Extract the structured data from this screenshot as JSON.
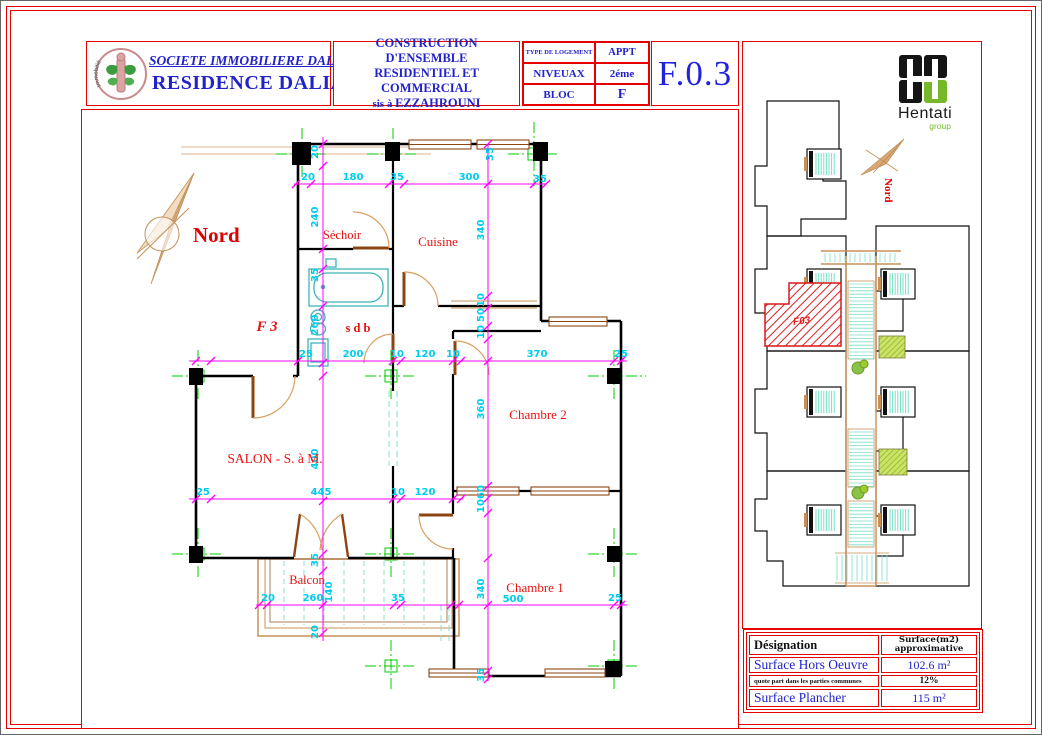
{
  "header": {
    "logo_arc_text": "Immobilière Dalia",
    "company": "SOCIETE  IMMOBILIERE DALIA",
    "residence": "RESIDENCE DALIA",
    "project_line1": "CONSTRUCTION D'ENSEMBLE",
    "project_line2": "RESIDENTIEL ET COMMERCIAL",
    "location_prefix": "sis à ",
    "location": "EZZAHROUNI",
    "type_table": {
      "r1c1": "TYPE DE LOGEMENT",
      "r1c2": "APPT",
      "r2c1": "NIVEUAX",
      "r2c2": "2éme",
      "r3c1": "BLOC",
      "r3c2": "F"
    },
    "code": "F.0.3"
  },
  "plan": {
    "north": "Nord",
    "flat_label": "F 3",
    "room_labels": [
      {
        "t": "Séchoir",
        "x": 341,
        "y": 238,
        "s": 12.5
      },
      {
        "t": "Cuisine",
        "x": 437,
        "y": 245,
        "s": 13
      },
      {
        "t": "s d b",
        "x": 357,
        "y": 331,
        "s": 12.5,
        "b": 1
      },
      {
        "t": "SALON - S. à M.",
        "x": 274,
        "y": 462,
        "s": 13.5
      },
      {
        "t": "Chambre 2",
        "x": 537,
        "y": 418,
        "s": 13
      },
      {
        "t": "Chambre 1",
        "x": 534,
        "y": 591,
        "s": 13
      },
      {
        "t": "Balcon",
        "x": 306,
        "y": 583,
        "s": 12.5
      }
    ],
    "dim_labels_h": [
      {
        "t": "20",
        "x": 307,
        "y": 179
      },
      {
        "t": "180",
        "x": 352,
        "y": 179
      },
      {
        "t": "35",
        "x": 396,
        "y": 179
      },
      {
        "t": "300",
        "x": 468,
        "y": 179
      },
      {
        "t": "35",
        "x": 539,
        "y": 181
      },
      {
        "t": "25",
        "x": 305,
        "y": 356
      },
      {
        "t": "200",
        "x": 352,
        "y": 356
      },
      {
        "t": "10",
        "x": 396,
        "y": 356
      },
      {
        "t": "120",
        "x": 424,
        "y": 356
      },
      {
        "t": "10",
        "x": 452,
        "y": 356
      },
      {
        "t": "370",
        "x": 536,
        "y": 356
      },
      {
        "t": "25",
        "x": 620,
        "y": 356
      },
      {
        "t": "25",
        "x": 202,
        "y": 494
      },
      {
        "t": "445",
        "x": 320,
        "y": 494
      },
      {
        "t": "10",
        "x": 397,
        "y": 494
      },
      {
        "t": "120",
        "x": 424,
        "y": 494
      },
      {
        "t": "20",
        "x": 267,
        "y": 600
      },
      {
        "t": "260",
        "x": 312,
        "y": 600
      },
      {
        "t": "35",
        "x": 397,
        "y": 600
      },
      {
        "t": "500",
        "x": 512,
        "y": 601
      },
      {
        "t": "25",
        "x": 614,
        "y": 600
      }
    ],
    "dim_labels_v": [
      {
        "t": "20",
        "x": 317,
        "y": 151
      },
      {
        "t": "240",
        "x": 317,
        "y": 216
      },
      {
        "t": "35",
        "x": 317,
        "y": 274
      },
      {
        "t": "260",
        "x": 317,
        "y": 324
      },
      {
        "t": "400",
        "x": 317,
        "y": 458
      },
      {
        "t": "35",
        "x": 317,
        "y": 559
      },
      {
        "t": "20",
        "x": 317,
        "y": 631
      },
      {
        "t": "140",
        "x": 331,
        "y": 591
      },
      {
        "t": "340",
        "x": 483,
        "y": 229
      },
      {
        "t": "10",
        "x": 483,
        "y": 299
      },
      {
        "t": "50",
        "x": 483,
        "y": 314
      },
      {
        "t": "10",
        "x": 483,
        "y": 331
      },
      {
        "t": "360",
        "x": 483,
        "y": 408
      },
      {
        "t": "60",
        "x": 483,
        "y": 491
      },
      {
        "t": "10",
        "x": 483,
        "y": 505
      },
      {
        "t": "340",
        "x": 483,
        "y": 588
      },
      {
        "t": "35",
        "x": 483,
        "y": 674
      },
      {
        "t": "35",
        "x": 492,
        "y": 153
      }
    ]
  },
  "site": {
    "north": "Nord",
    "brand": "Hentati",
    "brand_sub": "group",
    "unit": "F03"
  },
  "surface_table": {
    "col1_header": "Désignation",
    "col2_header_line1": "Surface(m2)",
    "col2_header_line2": "approximative",
    "rows": [
      {
        "label": "Surface  Hors Oeuvre",
        "value": "102.6 m²"
      },
      {
        "label": "quote part dans les parties communes",
        "value": "12%"
      },
      {
        "label": "Surface  Plancher",
        "value": "115 m²"
      }
    ]
  },
  "colors": {
    "border_red": "#e60000",
    "title_blue": "#2222cc",
    "dim_cyan": "#00cdee",
    "dim_magenta": "#ff00ff",
    "axis_green": "#00cc00",
    "label_red": "#e81212",
    "door_tan": "#d8a060",
    "wood_brown": "#8b4513",
    "fixture_cyan": "#3fb3b8",
    "brand_green": "#76b82a"
  }
}
